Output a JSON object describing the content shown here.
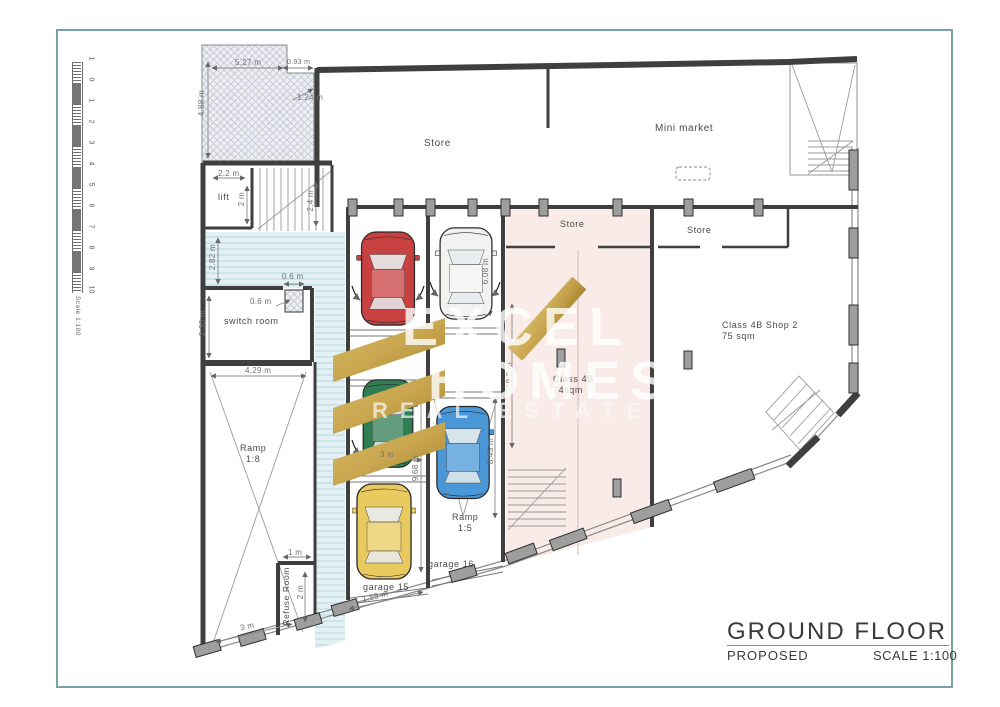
{
  "title_block": {
    "title": "GROUND FLOOR",
    "status": "PROPOSED",
    "scale": "SCALE 1:100"
  },
  "ruler": {
    "labels": [
      "1",
      "0",
      "1",
      "2",
      "3",
      "4",
      "5",
      "6",
      "7",
      "8",
      "9",
      "10"
    ],
    "scale": "Scale 1:100"
  },
  "labels": {
    "store_main": "Store",
    "mini_market": "Mini market",
    "store_left": "Store",
    "store_right": "Store",
    "shop2_1": "Class 4B Shop 2",
    "shop2_2": "75 sqm",
    "c4b_1": "Class 4B",
    "c4b_2": "74sqm",
    "lift": "lift",
    "switch_room": "switch room",
    "ramp18_1": "Ramp",
    "ramp18_2": "1:8",
    "ramp15_1": "Ramp",
    "ramp15_2": "1:5",
    "garage15": "garage 15",
    "garage16": "garage 16",
    "refuse": "Refuse Room"
  },
  "dims": {
    "a": "5.27 m",
    "b": "0.93 m",
    "c": "1.24 m",
    "d": "4.88 m",
    "e": "2.2 m",
    "f": "2 m",
    "g": "2.4 m",
    "h": "2.82 m",
    "i": "0.6 m",
    "j": "0.6 m",
    "k": "2.30 m",
    "l": "4.29 m",
    "m": "6.08 m",
    "n": "3 m",
    "o": "9.68 m",
    "p": "9.2 m",
    "q": "8.45 m",
    "r": "1 m",
    "s": "2 m",
    "t": "1.55 m",
    "u": "3 m"
  },
  "watermark": {
    "line1": "EXCEL",
    "line2": "HOMES",
    "line3": "REAL ESTATE"
  },
  "colors": {
    "border": "#7aa2a6",
    "pink": "#f9ece8",
    "gold": "#c9a64f",
    "gold_dark": "#a9882f",
    "car_red": "#c94040",
    "car_white": "#f2f2f0",
    "car_green": "#2f7d52",
    "car_blue": "#4a97d8",
    "car_yellow": "#e9ca5e"
  }
}
